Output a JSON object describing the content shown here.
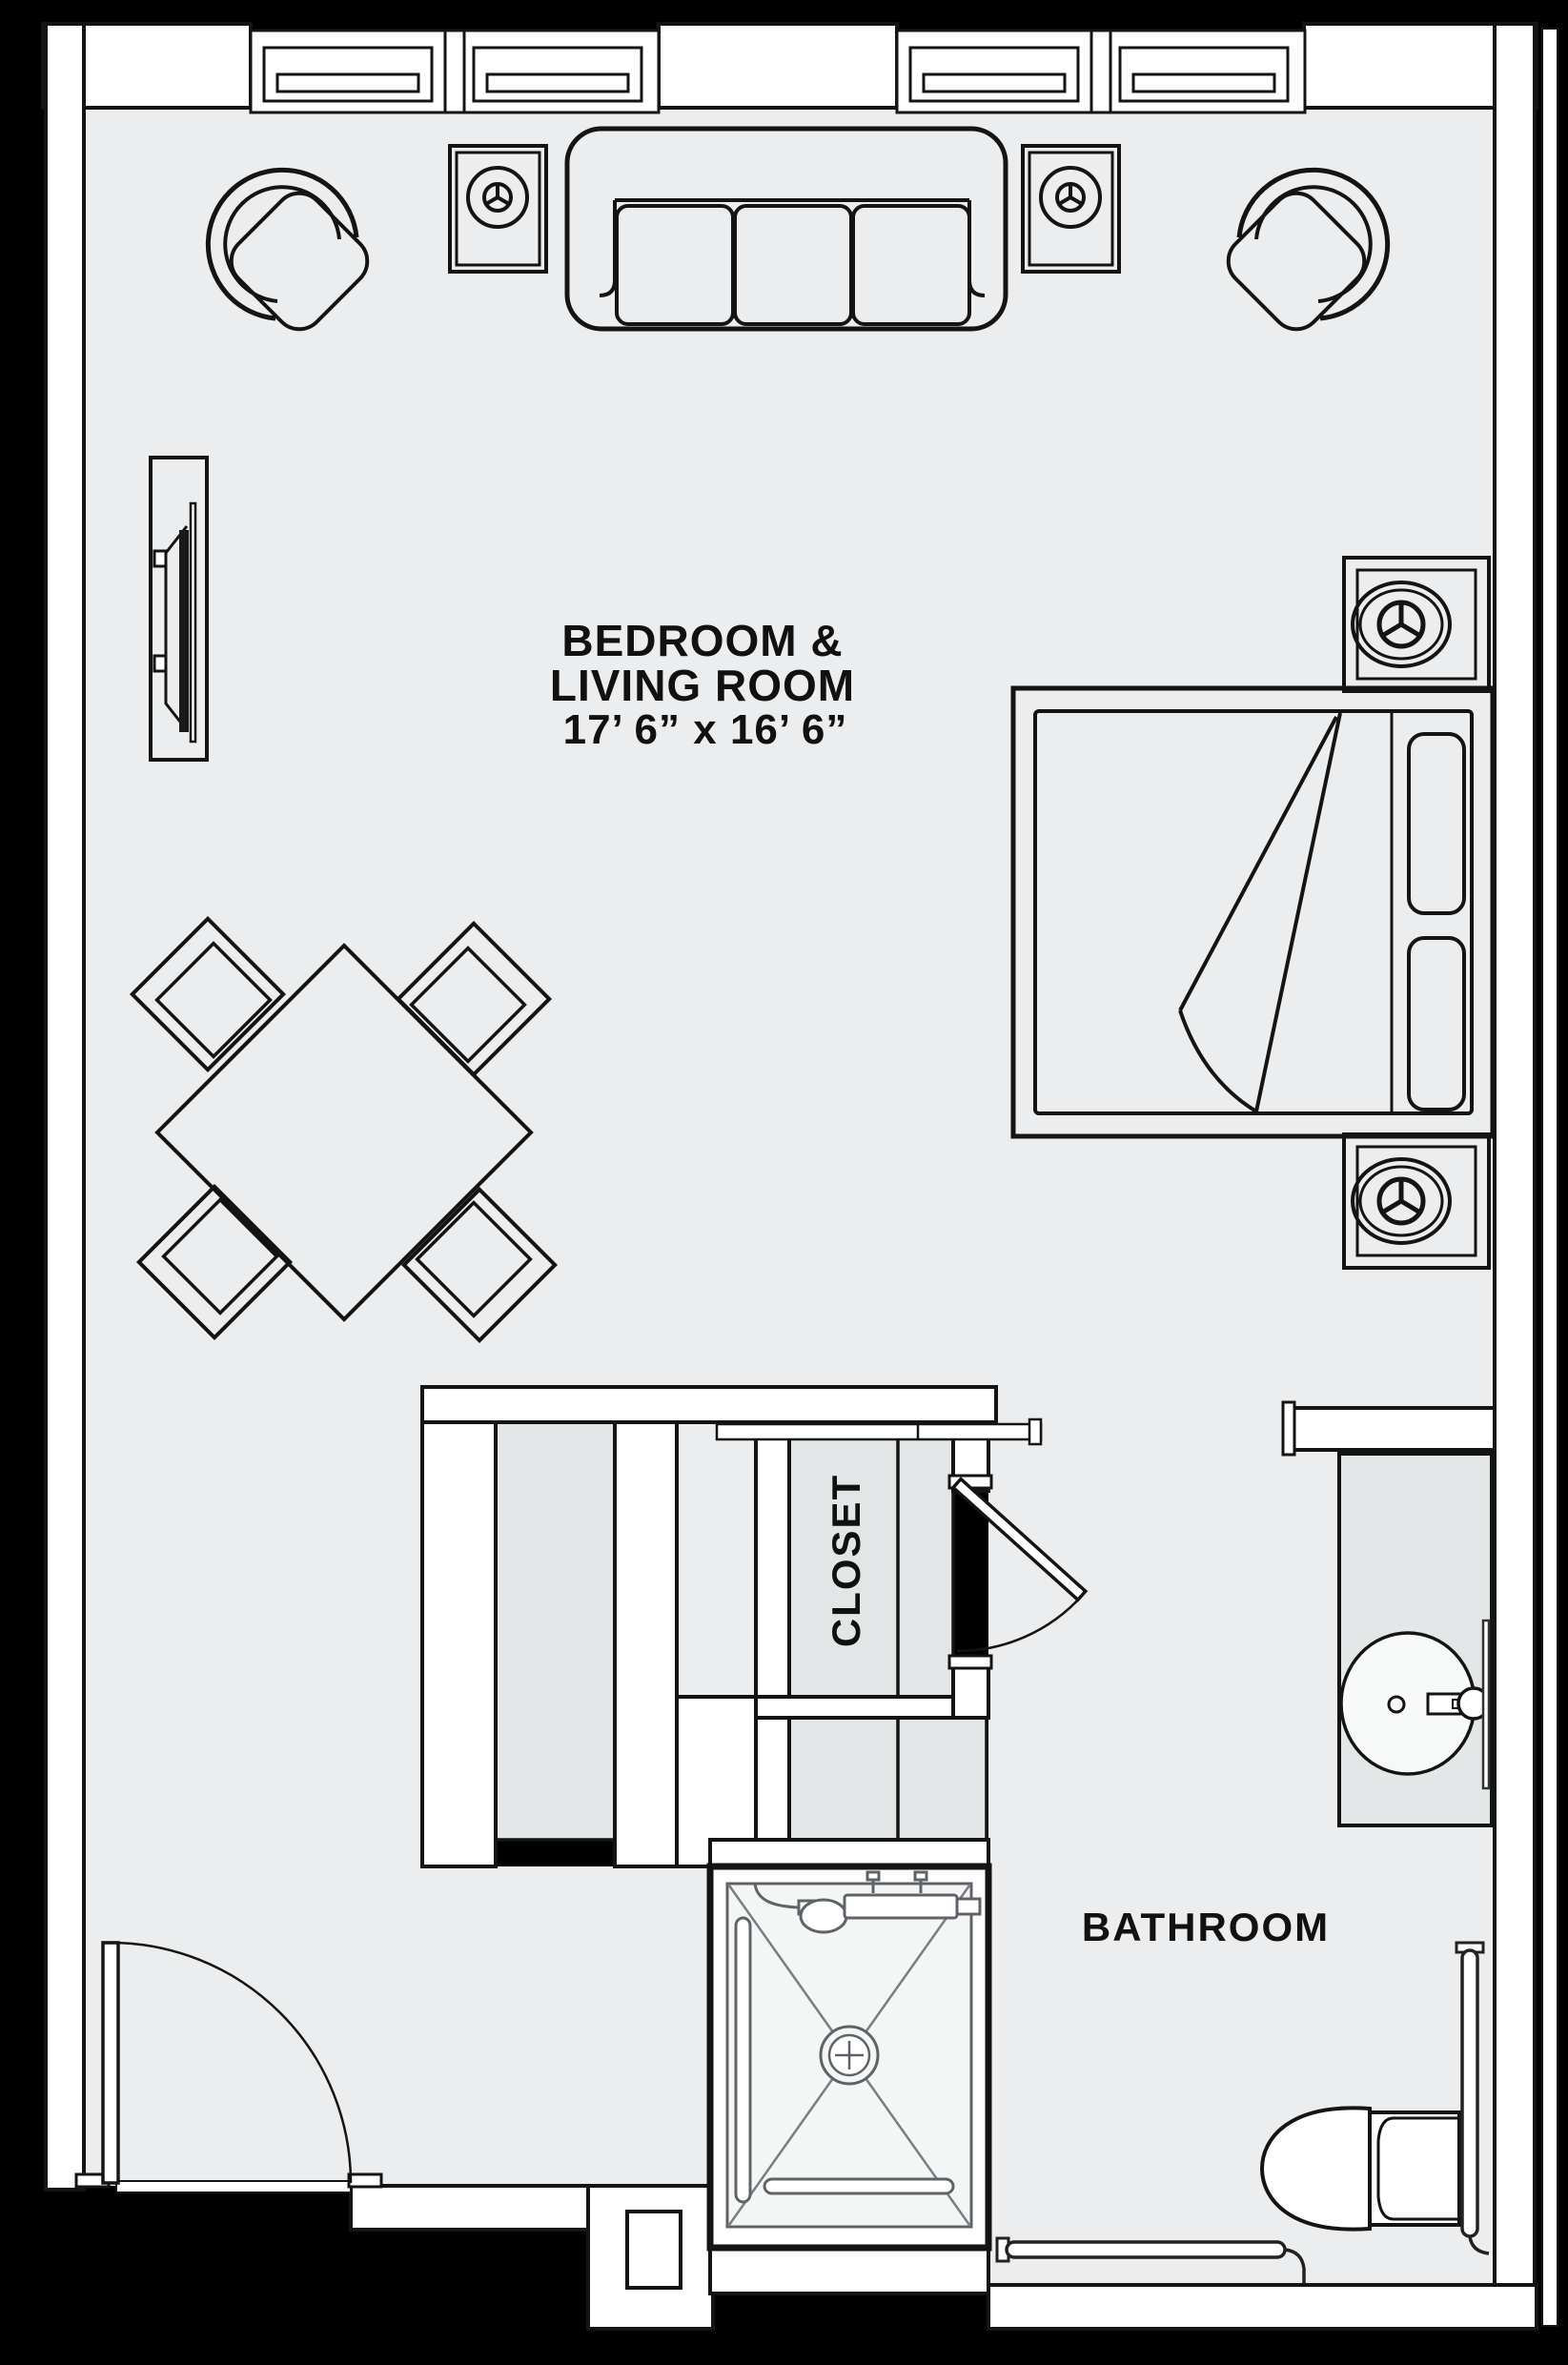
{
  "plan": {
    "type": "apartment-floor-plan",
    "labels": {
      "main_room_line1": "BEDROOM &",
      "main_room_line2": "LIVING ROOM",
      "main_room_dimensions": "17’ 6” x 16’ 6”",
      "closet": "CLOSET",
      "bathroom": "BATHROOM"
    },
    "rooms": [
      {
        "name": "Bedroom & Living Room",
        "dimensions": "17' 6\" x 16' 6\""
      },
      {
        "name": "Closet"
      },
      {
        "name": "Bathroom"
      }
    ],
    "furniture_icons": [
      "sofa-icon",
      "barrel-chair-icon",
      "end-table-lamp-icon",
      "tv-console-icon",
      "dining-table-icon",
      "dining-chair-icon",
      "bed-icon",
      "nightstand-lamp-icon",
      "closet-shelf-icon",
      "door-swing-icon",
      "window-icon",
      "vanity-sink-icon",
      "shower-icon",
      "grab-bar-icon",
      "toilet-icon"
    ],
    "colors": {
      "outside": "#000000",
      "floor": "#ebedee",
      "wall": "#ffffff",
      "outline": "#141414",
      "closet_fill": "#e3e6e6",
      "counter_fill": "#e4e7e7",
      "shower_pan": "#f4f6f6",
      "detail_line": "#5f6368",
      "text": "#111111"
    }
  }
}
